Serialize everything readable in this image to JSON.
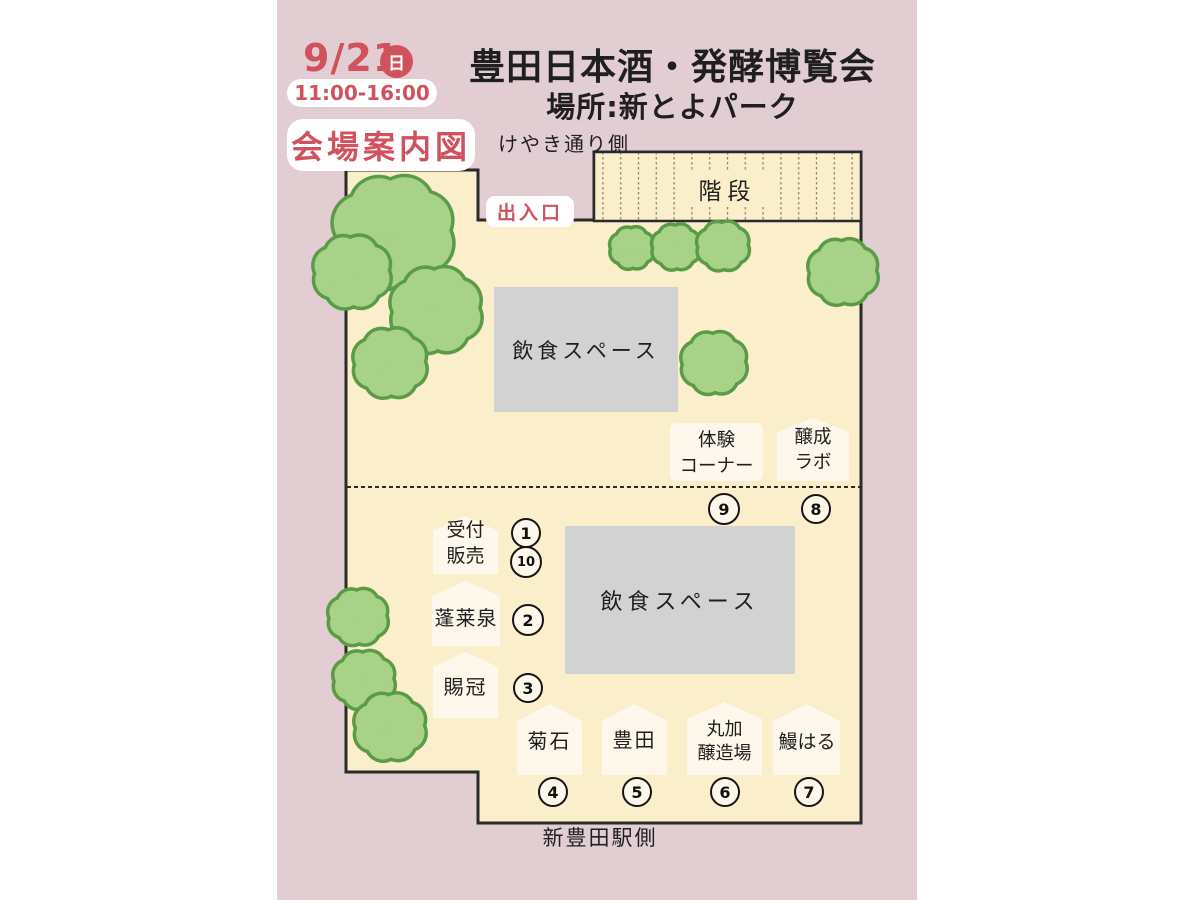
{
  "header": {
    "date": "9/21",
    "day": "日",
    "time": "11:00-16:00",
    "map_label": "会場案内図",
    "title": "豊田日本酒・発酵博覧会",
    "location": "場所:新とよパーク"
  },
  "map": {
    "street_side_label": "けやき通り側",
    "station_side_label": "新豊田駅側",
    "entrance_label": "出入口",
    "stairs_label": "階段",
    "dining_upper_label": "飲食スペース",
    "dining_lower_label": "飲食スペース",
    "booths": [
      {
        "id": "reception-sales",
        "numbers": [
          "1",
          "10"
        ],
        "lines": [
          "受付",
          "販売"
        ]
      },
      {
        "id": "horaisen",
        "numbers": [
          "2"
        ],
        "lines": [
          "蓬莱泉"
        ]
      },
      {
        "id": "shikan",
        "numbers": [
          "3"
        ],
        "lines": [
          "賜冠"
        ]
      },
      {
        "id": "kikuishi",
        "numbers": [
          "4"
        ],
        "lines": [
          "菊石"
        ]
      },
      {
        "id": "toyota",
        "numbers": [
          "5"
        ],
        "lines": [
          "豊田"
        ]
      },
      {
        "id": "maruka-jozojo",
        "numbers": [
          "6"
        ],
        "lines": [
          "丸加",
          "醸造場"
        ]
      },
      {
        "id": "unagi-haru",
        "numbers": [
          "7"
        ],
        "lines": [
          "鰻はる"
        ]
      },
      {
        "id": "josei-lab",
        "numbers": [
          "8"
        ],
        "lines": [
          "醸成",
          "ラボ"
        ]
      },
      {
        "id": "taiken-corner",
        "numbers": [
          "9"
        ],
        "lines": [
          "体験",
          "コーナー"
        ]
      }
    ]
  },
  "colors": {
    "accent_red": "#d0525c",
    "canvas_pink": "#e2cdd2",
    "venue_cream": "#faeecb",
    "booth_white": "#fdf8eb",
    "dining_gray": "#d2d2d2",
    "tree_fill": "#a7d287",
    "tree_stroke": "#5a9b48"
  }
}
